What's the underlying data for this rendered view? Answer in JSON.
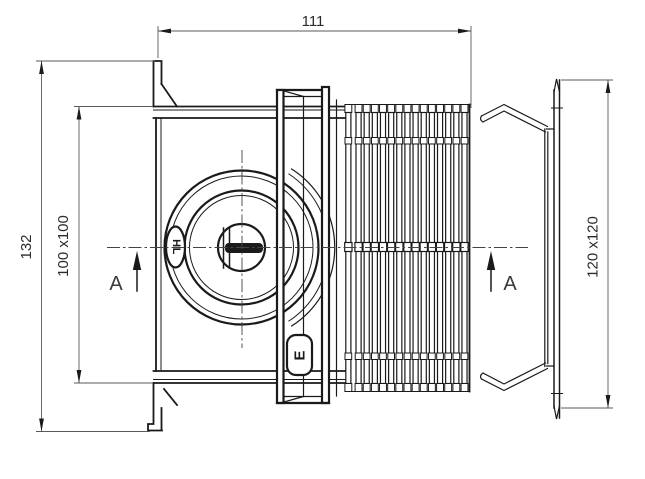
{
  "drawing": {
    "background": "#ffffff",
    "line_color": "#1a1a1a",
    "dimensions": {
      "length": "111",
      "overall_height": "132",
      "inner_flange": "100 x100",
      "wall_flange": "120 x120"
    },
    "section": {
      "left_label": "A",
      "right_label": "A"
    },
    "part_markings": {
      "brand_badge": "HL",
      "latch_mark": "E"
    }
  }
}
